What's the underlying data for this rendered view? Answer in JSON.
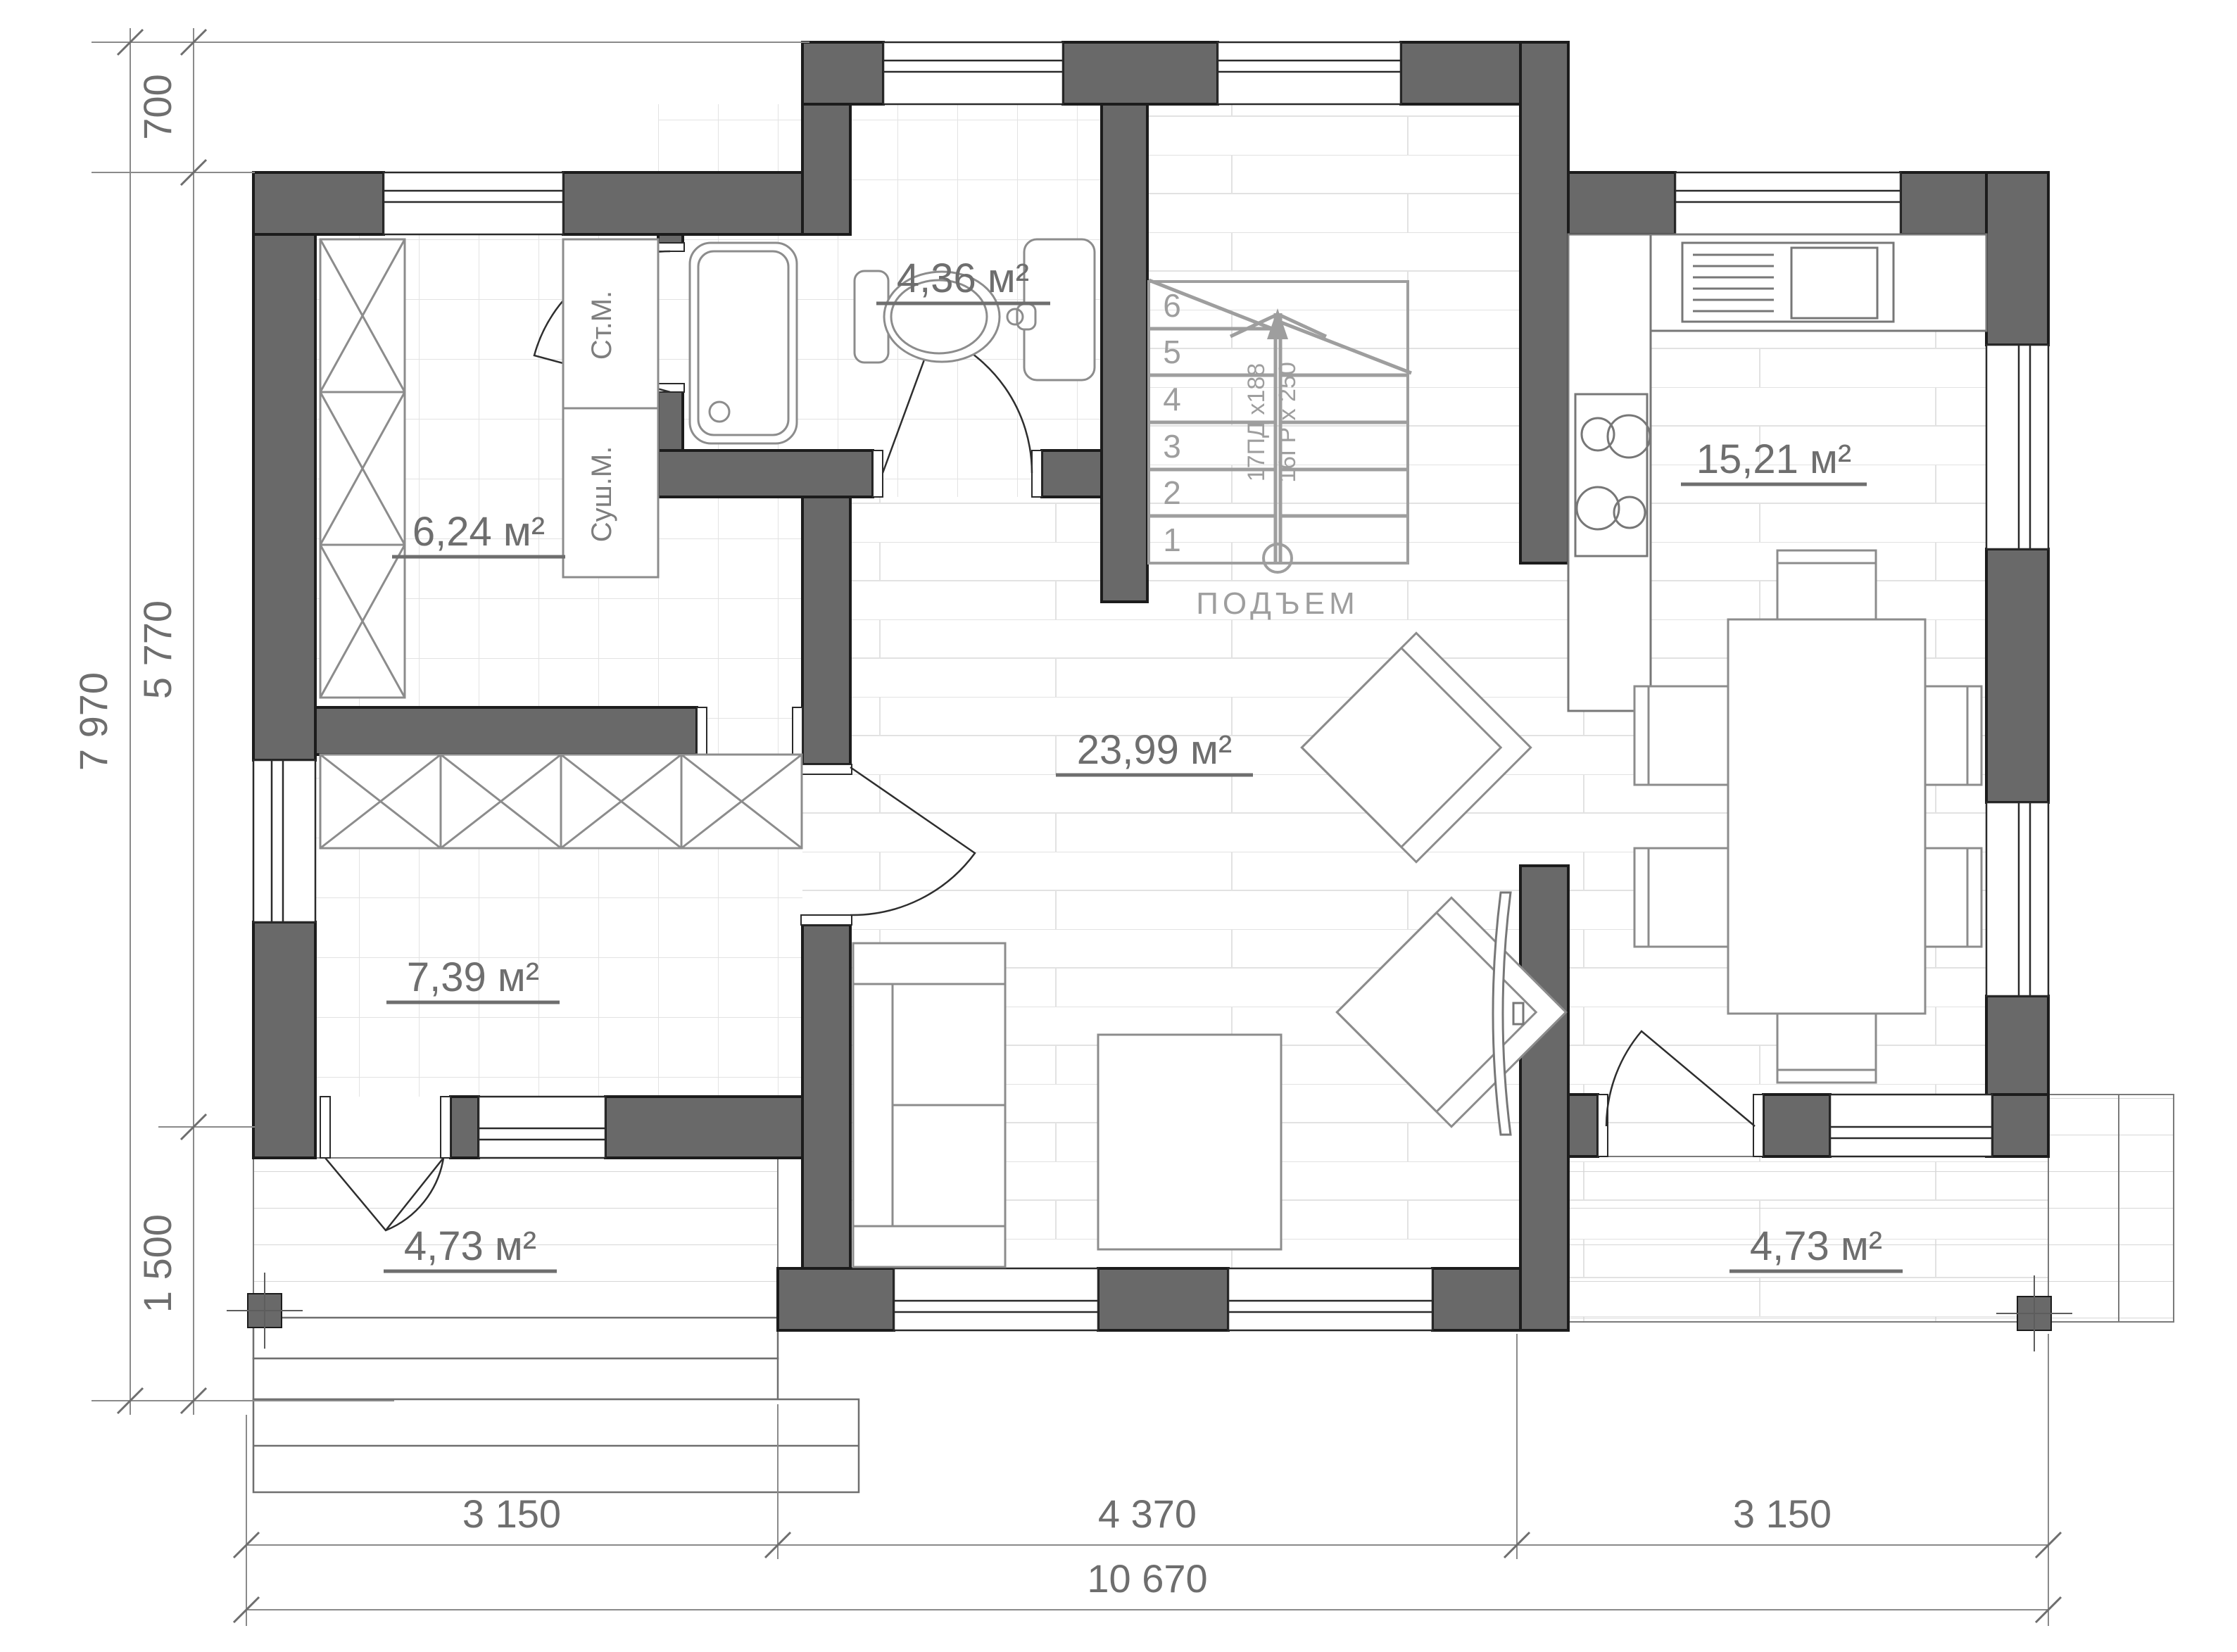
{
  "rooms": {
    "bathroom": "4,36 м²",
    "laundry": "6,24 м²",
    "kitchen": "15,21 м²",
    "living": "23,99 м²",
    "hall": "7,39 м²",
    "terrace_left": "4,73 м²",
    "terrace_right": "4,73 м²"
  },
  "appliances": {
    "washing_machine": "Ст.М.",
    "dryer": "Суш.М."
  },
  "stairs": {
    "label": "ПОДЪЕМ",
    "steps": [
      "1",
      "2",
      "3",
      "4",
      "5",
      "6"
    ],
    "note_risers": "17ПД х188",
    "note_treads": "16ГР х 250"
  },
  "dimensions": {
    "vertical_total": "7 970",
    "vertical_top_offset": "700",
    "vertical_main": "5 770",
    "vertical_terrace": "1 500",
    "bottom_left": "3 150",
    "bottom_center": "4 370",
    "bottom_right": "3 150",
    "bottom_total": "10 670"
  },
  "colors": {
    "wall": "#696969",
    "dim_text": "#6e6e6e"
  }
}
